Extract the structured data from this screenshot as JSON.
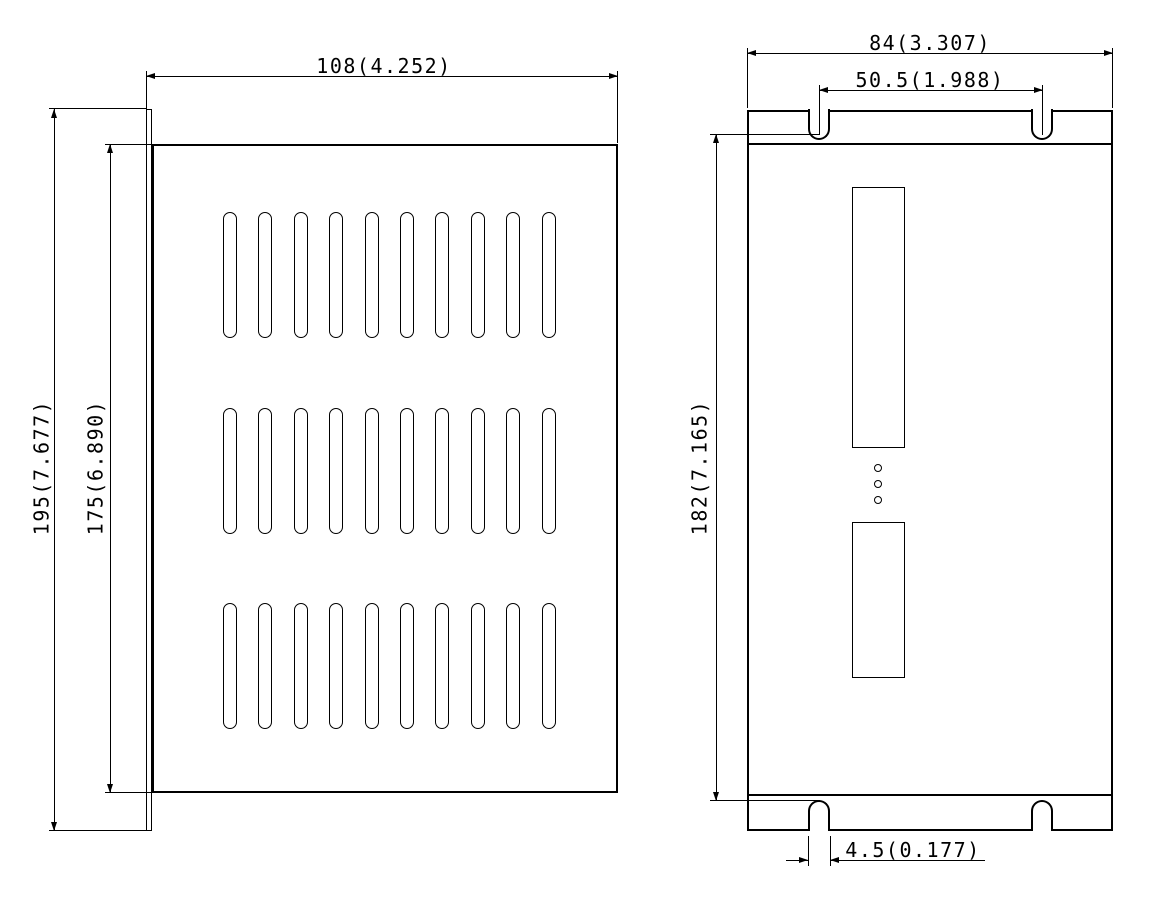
{
  "drawing": {
    "background": "#ffffff",
    "line_color": "#000000",
    "left_view": {
      "name": "side-view-with-vent-slots",
      "dim_width": "108(4.252)",
      "dim_height_outer": "195(7.677)",
      "dim_height_body": "175(6.890)",
      "vent_slots": {
        "rows": 3,
        "columns": 10
      }
    },
    "right_view": {
      "name": "front-view-with-mounting-slots",
      "dim_width": "84(3.307)",
      "dim_slot_spacing": "50.5(1.988)",
      "dim_height": "182(7.165)",
      "dim_slot_width": "4.5(0.177)",
      "connector_count": 2,
      "led_hole_count": 3,
      "mounting_notch_count": 4
    }
  }
}
